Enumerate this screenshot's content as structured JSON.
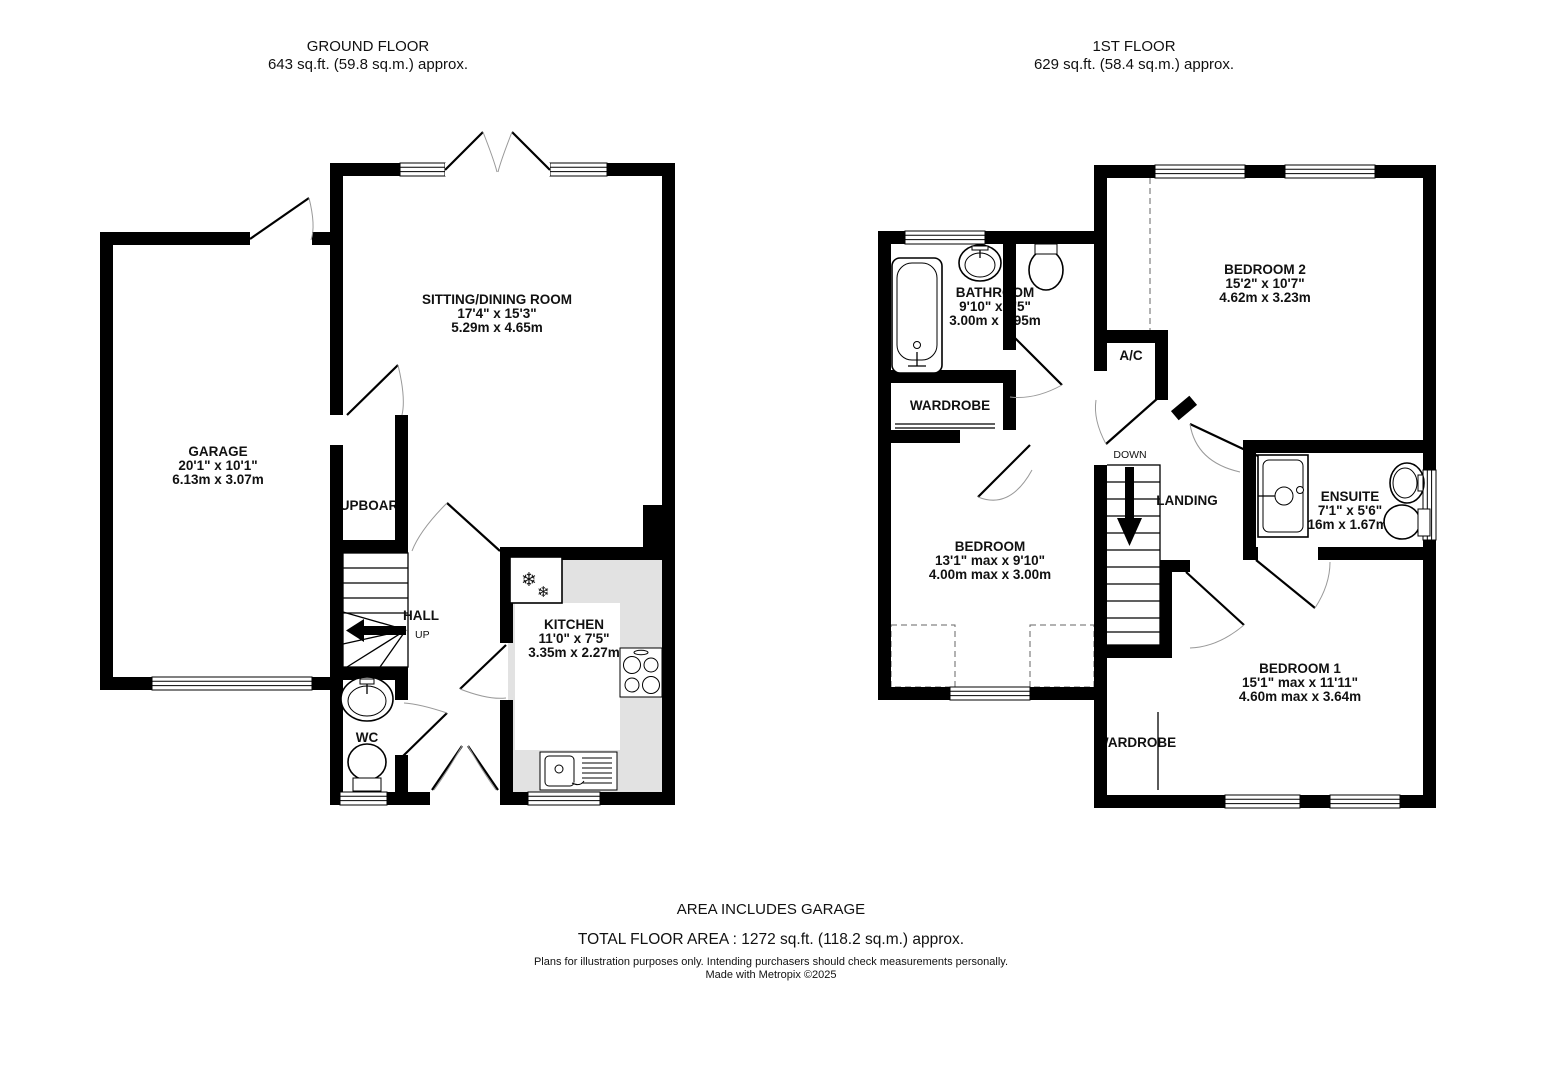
{
  "ground_floor": {
    "title": "GROUND FLOOR",
    "subtitle": "643 sq.ft. (59.8 sq.m.) approx.",
    "rooms": {
      "sitting_dining": {
        "name": "SITTING/DINING ROOM",
        "imperial": "17'4\"  x 15'3\"",
        "metric": "5.29m  x 4.65m"
      },
      "garage": {
        "name": "GARAGE",
        "imperial": "20'1\"  x 10'1\"",
        "metric": "6.13m  x 3.07m"
      },
      "kitchen": {
        "name": "KITCHEN",
        "imperial": "11'0\"  x 7'5\"",
        "metric": "3.35m  x 2.27m"
      },
      "cupboard": {
        "name": "CUPBOARD"
      },
      "hall": {
        "name": "HALL"
      },
      "wc": {
        "name": "WC"
      }
    },
    "stairs_label": "UP"
  },
  "first_floor": {
    "title": "1ST FLOOR",
    "subtitle": "629 sq.ft. (58.4 sq.m.) approx.",
    "rooms": {
      "bathroom": {
        "name": "BATHROOM",
        "imperial": "9'10\"  x 6'5\"",
        "metric": "3.00m  x 1.95m"
      },
      "bedroom2": {
        "name": "BEDROOM 2",
        "imperial": "15'2\"  x 10'7\"",
        "metric": "4.62m  x 3.23m"
      },
      "bedroom": {
        "name": "BEDROOM",
        "imperial": "13'1\" max x 9'10\"",
        "metric": "4.00m max x 3.00m"
      },
      "bedroom1": {
        "name": "BEDROOM 1",
        "imperial": "15'1\" max x 11'11\"",
        "metric": "4.60m max x 3.64m"
      },
      "ensuite": {
        "name": "ENSUITE",
        "imperial": "7'1\"  x 5'6\"",
        "metric": "2.16m  x 1.67m"
      },
      "wardrobe": {
        "name": "WARDROBE"
      },
      "wardrobe2": {
        "name": "WARDROBE"
      },
      "ac": {
        "name": "A/C"
      },
      "landing": {
        "name": "LANDING"
      }
    },
    "stairs_label": "DOWN"
  },
  "footer": {
    "note": "AREA INCLUDES GARAGE",
    "total": "TOTAL FLOOR AREA : 1272 sq.ft. (118.2 sq.m.) approx.",
    "disclaimer": "Plans for illustration purposes only. Intending purchasers should check measurements personally.",
    "credit": "Made with Metropix ©2025"
  },
  "icons": {
    "fridge": "❄"
  }
}
